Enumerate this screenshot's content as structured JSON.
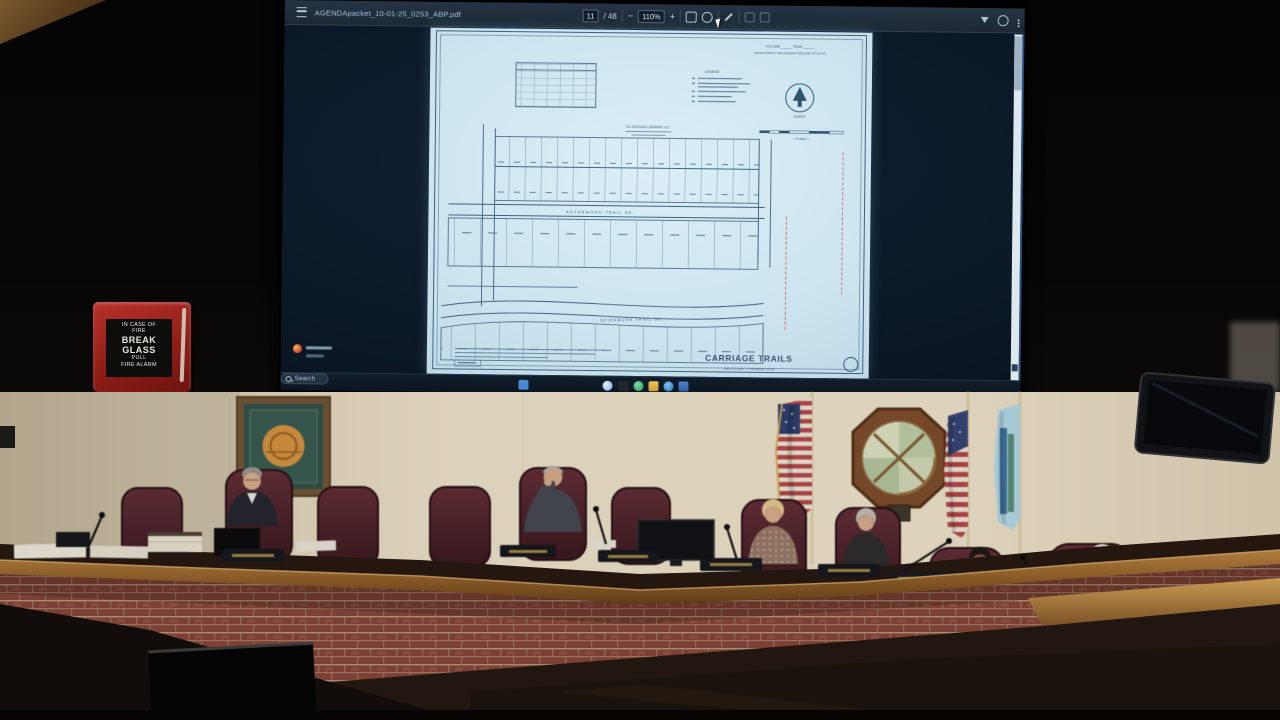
{
  "window": {
    "filename": "AGENDApacket_10-01-25_0253_ABP.pdf",
    "page_current": "11",
    "page_divider": "/ 48",
    "zoom_out": "−",
    "zoom_value": "110%",
    "zoom_in": "+"
  },
  "taskbar": {
    "search_label": "Search"
  },
  "plat": {
    "volume_line": "VOLUME ______ PAGE ______",
    "recorder_line": "MIAMI COUNTY RECORDER'S RECORD OF PLATS",
    "legend_title": "LEGEND",
    "north_label": "NORTH",
    "scale_label": "( IN FEET )",
    "owner_line": "TJC HOLDING COMPANY LLC",
    "street_top": "ASTERWOOD TRAIL SE.",
    "street_bottom": "SPICEBUSH TRAIL SE.",
    "title": "CARRIAGE TRAILS",
    "subtitle": "SECTION 7 PHASE V-A"
  },
  "fire_alarm": {
    "lines": [
      "IN CASE OF",
      "FIRE",
      "BREAK",
      "GLASS",
      "PULL",
      "FIRE ALARM"
    ]
  },
  "colors": {
    "pdf_page": "#cfe7f3",
    "plat_ink": "#35607d",
    "toolbar": "#1f2d3d",
    "desktop": "#0a1828",
    "alarm_red": "#a8241e",
    "wall": "#d8cdb6",
    "brick": "#7c4134",
    "wood_rail": "#9a6a35",
    "chair": "#46222a"
  }
}
